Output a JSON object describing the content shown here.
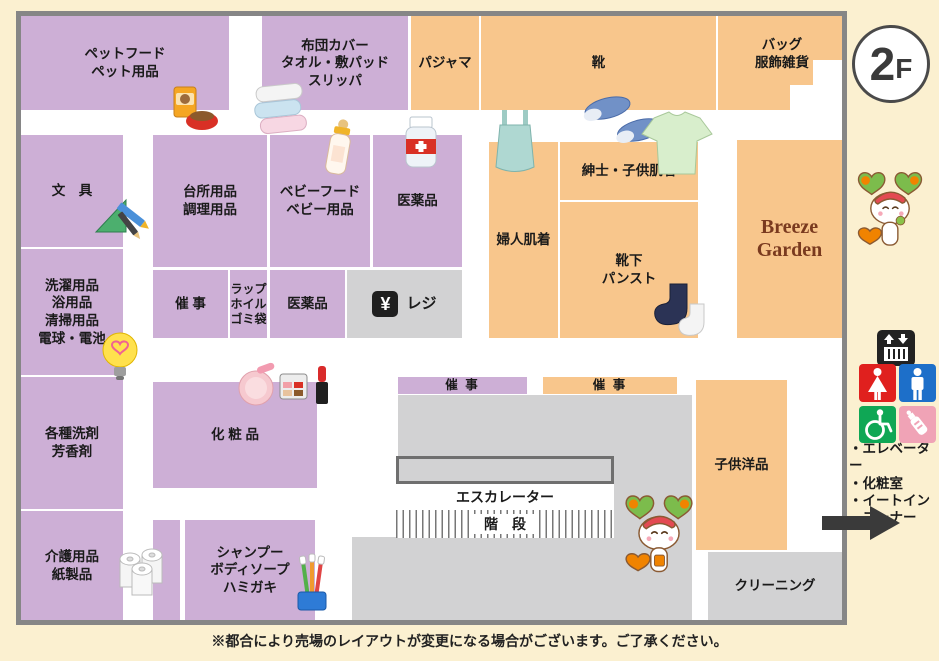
{
  "floor_badge": {
    "number": "2",
    "suffix": "F"
  },
  "sections": {
    "pet_food": {
      "label": "ペットフード\nペット用品"
    },
    "futon": {
      "label": "布団カバー\nタオル・敷パッド\nスリッパ"
    },
    "pajamas": {
      "label": "パジャマ"
    },
    "shoes": {
      "label": "靴"
    },
    "bags": {
      "label": "バッグ\n服飾雑貨"
    },
    "stationery": {
      "label": "文　具"
    },
    "kitchen": {
      "label": "台所用品\n調理用品"
    },
    "baby": {
      "label": "ベビーフード\nベビー用品"
    },
    "medicine_upper": {
      "label": "医薬品"
    },
    "laundry": {
      "label": "洗濯用品\n浴用品\n清掃用品\n電球・電池"
    },
    "event_west": {
      "label": "催 事"
    },
    "wrap": {
      "label": "ラップ\nホイル\nゴミ袋"
    },
    "medicine_lower": {
      "label": "医薬品"
    },
    "register": {
      "label": "レジ",
      "symbol": "¥"
    },
    "womens_underwear": {
      "label": "婦人肌着"
    },
    "mens_kids_underwear": {
      "label": "紳士・子供肌着"
    },
    "socks": {
      "label": "靴下\nパンスト"
    },
    "breeze_garden": {
      "label": "Breeze\nGarden"
    },
    "detergents": {
      "label": "各種洗剤\n芳香剤"
    },
    "cosmetics": {
      "label": "化 粧 品"
    },
    "care_paper": {
      "label": "介護用品\n紙製品"
    },
    "shampoo": {
      "label": "シャンプー\nボディソープ\nハミガキ"
    },
    "event_center_left": {
      "label": "催 事"
    },
    "event_center_right": {
      "label": "催 事"
    },
    "kids_clothing": {
      "label": "子供洋品"
    },
    "cleaning": {
      "label": "クリーニング"
    },
    "escalator": {
      "label": "エスカレーター"
    },
    "stairs": {
      "label": "階　段"
    }
  },
  "legend": {
    "facilities": "・エレベーター\n・化粧室\n・イートイン\n　コーナー"
  },
  "footer": {
    "note": "※都合により売場のレイアウトが変更になる場合がございます。ご了承ください。"
  },
  "colors": {
    "background_cream": "#FBF0D0",
    "section_purple": "#CDAFD6",
    "section_orange": "#F8C68C",
    "section_gray": "#D2D2D3",
    "frame_gray": "#868686",
    "restroom_woman_red": "#E0201E",
    "restroom_man_blue": "#1D6FC9",
    "wheelchair_green": "#0FA755",
    "nursing_pink": "#F0A3B6",
    "breeze_text_brown": "#7A3A1F"
  },
  "icons": [
    "dog-food",
    "towels",
    "baby-bottle",
    "medicine-bottle",
    "camisole",
    "shoes",
    "t-shirt",
    "stationery",
    "light-bulb",
    "cosmetics",
    "toilet-paper",
    "toothbrushes",
    "socks",
    "yen",
    "mascot",
    "elevator",
    "restroom-woman",
    "restroom-man",
    "wheelchair",
    "nursing-bottle",
    "arrow-right"
  ]
}
